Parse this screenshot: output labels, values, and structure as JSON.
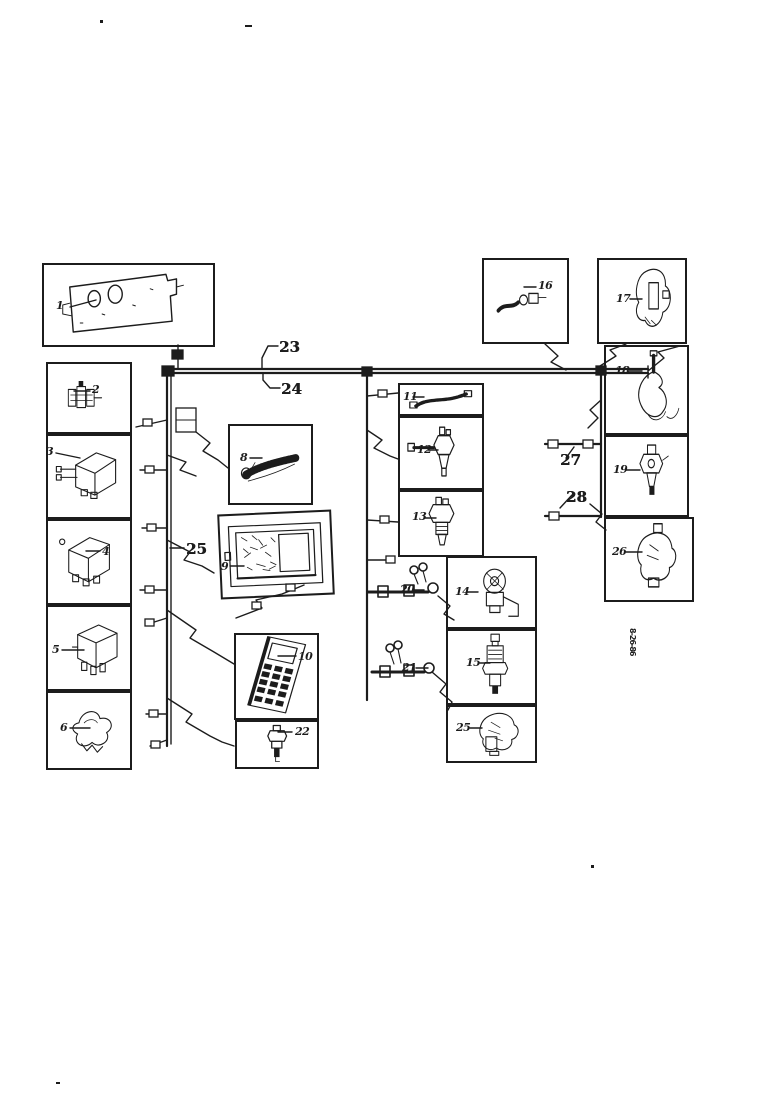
{
  "diagram": {
    "background_color": "#ffffff",
    "ink_color": "#1c1c1c",
    "vertical_code": "8-26-86",
    "callouts": [
      {
        "name": "part-1",
        "label": "1"
      },
      {
        "name": "part-2",
        "label": "2"
      },
      {
        "name": "part-3",
        "label": "3"
      },
      {
        "name": "part-4",
        "label": "4"
      },
      {
        "name": "part-5",
        "label": "5"
      },
      {
        "name": "part-6",
        "label": "6"
      },
      {
        "name": "part-8",
        "label": "8"
      },
      {
        "name": "part-9",
        "label": "9"
      },
      {
        "name": "part-10",
        "label": "10"
      },
      {
        "name": "part-11",
        "label": "11"
      },
      {
        "name": "part-12",
        "label": "12"
      },
      {
        "name": "part-13",
        "label": "13"
      },
      {
        "name": "part-14",
        "label": "14"
      },
      {
        "name": "part-15",
        "label": "15"
      },
      {
        "name": "part-16",
        "label": "16"
      },
      {
        "name": "part-17",
        "label": "17"
      },
      {
        "name": "part-18",
        "label": "18"
      },
      {
        "name": "part-19",
        "label": "19"
      },
      {
        "name": "part-20",
        "label": "20"
      },
      {
        "name": "part-21",
        "label": "21"
      },
      {
        "name": "part-22",
        "label": "22"
      },
      {
        "name": "harness-23",
        "label": "23"
      },
      {
        "name": "harness-24",
        "label": "24"
      },
      {
        "name": "harness-25",
        "label": "25"
      },
      {
        "name": "part-25",
        "label": "25"
      },
      {
        "name": "part-26",
        "label": "26"
      },
      {
        "name": "harness-27",
        "label": "27"
      },
      {
        "name": "harness-28",
        "label": "28"
      }
    ]
  }
}
